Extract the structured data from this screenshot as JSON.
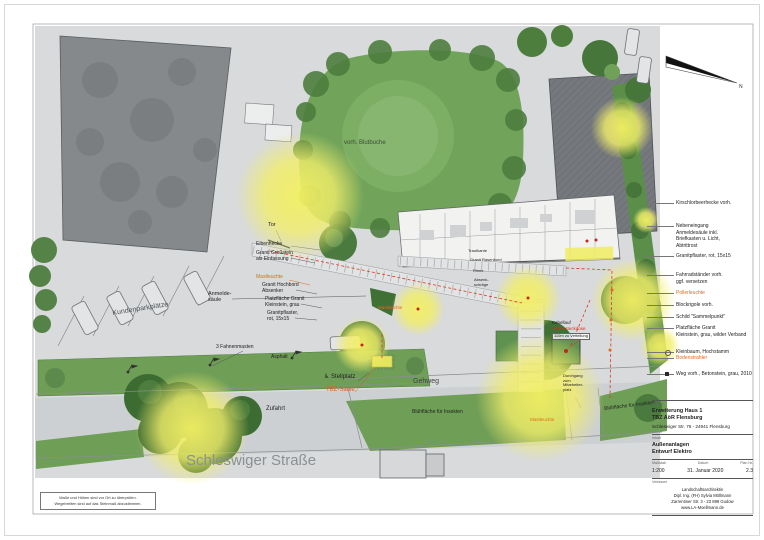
{
  "plan": {
    "labels": [
      {
        "text": "Tor",
        "x": 268,
        "y": 222,
        "size": 5.5
      },
      {
        "text": "Anmelde-\nsäule",
        "x": 208,
        "y": 291,
        "size": 5.5
      },
      {
        "text": "Eibenhecke",
        "x": 256,
        "y": 242,
        "size": 5
      },
      {
        "text": "Granit Großstein\nals Einfassung",
        "x": 256,
        "y": 251,
        "size": 5
      },
      {
        "text": "Mastleuchte",
        "x": 256,
        "y": 275,
        "size": 5,
        "color": "#e06a1f"
      },
      {
        "text": "Granit Hochbord\nAbsenker",
        "x": 262,
        "y": 283,
        "size": 5
      },
      {
        "text": "Platzfläche Granit\nKleinstein, grau",
        "x": 265,
        "y": 297,
        "size": 5
      },
      {
        "text": "Granitpflaster,\nrot, 15x15",
        "x": 267,
        "y": 311,
        "size": 5
      },
      {
        "text": "vorh. Blutbuche",
        "x": 344,
        "y": 140,
        "size": 6,
        "color": "#3c4a38"
      },
      {
        "text": "Kundenparkplätze",
        "x": 112,
        "y": 310,
        "size": 7,
        "rotate": -9,
        "color": "#4d5256"
      },
      {
        "text": "3 Fahnenmasten",
        "x": 216,
        "y": 345,
        "size": 5
      },
      {
        "text": "Asphalt",
        "x": 271,
        "y": 355,
        "size": 5
      },
      {
        "text": "♿ Stellplatz",
        "x": 324,
        "y": 374,
        "size": 6
      },
      {
        "text": "TBZ-Säule",
        "x": 326,
        "y": 387,
        "size": 6,
        "color": "#e8541e"
      },
      {
        "text": "Gehweg",
        "x": 413,
        "y": 378,
        "size": 7,
        "color": "#3f4447"
      },
      {
        "text": "Zufahrt",
        "x": 266,
        "y": 406,
        "size": 6
      },
      {
        "text": "Schleswiger Straße",
        "x": 186,
        "y": 452,
        "size": 15,
        "color": "#8b9094"
      },
      {
        "text": "Blühfläche für Insekten",
        "x": 412,
        "y": 410,
        "size": 5
      },
      {
        "text": "Blühfläche für Insekten",
        "x": 604,
        "y": 407,
        "size": 5,
        "rotate": -7
      },
      {
        "text": "Kabellauf",
        "x": 552,
        "y": 320,
        "size": 4.5
      },
      {
        "text": "Außensteckdose",
        "x": 552,
        "y": 326,
        "size": 4.5,
        "color": "#d6301c"
      },
      {
        "text": "110m zu Verteilung",
        "x": 552,
        "y": 333,
        "size": 4,
        "boxed": true
      },
      {
        "text": "Mastleuchte",
        "x": 378,
        "y": 305,
        "size": 4.5,
        "color": "#e06a1f"
      },
      {
        "text": "Mastleuchte",
        "x": 530,
        "y": 417,
        "size": 4.5,
        "color": "#e06a1f"
      },
      {
        "text": "Durchgang\nzum\nMitarbeiter-\nplatz",
        "x": 563,
        "y": 374,
        "size": 4
      },
      {
        "text": "Traufkante",
        "x": 468,
        "y": 249,
        "size": 4
      },
      {
        "text": "Granit Rasenbord",
        "x": 470,
        "y": 258,
        "size": 4
      },
      {
        "text": "Rinne",
        "x": 473,
        "y": 269,
        "size": 4
      },
      {
        "text": "Absenk-\nschräge",
        "x": 474,
        "y": 278,
        "size": 4
      }
    ]
  },
  "legend": {
    "items": [
      {
        "lines": "Kirschlorbeerhecke vorh.",
        "y": 200
      },
      {
        "lines": "Nebeneingang\nAnmeldesäule inkl.\nBriefkasten u. Licht,\nAbtrittrost",
        "y": 223
      },
      {
        "lines": "Granitpflaster, rot, 15x15",
        "y": 253
      },
      {
        "lines": "Fahrradständer vorh.\nggf. versetzen",
        "y": 272
      },
      {
        "lines": "Pollerleuchte",
        "y": 290,
        "color": "#e06a1f"
      },
      {
        "lines": "Blockrigole vorh.",
        "y": 302
      },
      {
        "lines": "Schild \"Sammelpunkt\"",
        "y": 314
      },
      {
        "lines": "Platzfläche Granit\nKleinstein, grau, wilder Verband",
        "y": 325
      },
      {
        "lines": "Kleinbaum, Hochstamm",
        "y": 349,
        "symbol": "circle"
      },
      {
        "lines": "Bodenstrahler",
        "y": 355,
        "color": "#e06a1f"
      },
      {
        "lines": "Weg vorh., Betonstein, grau, 2010",
        "y": 371,
        "symbol": "square"
      }
    ]
  },
  "north_arrow": {
    "label": "N"
  },
  "title_block": {
    "section_project_label": "Projekt",
    "project_line1": "Erweiterung Haus 1",
    "project_line2": "TBZ AöR Flensburg",
    "project_address": "Schleswiger Str. 76 - 24941 Flensburg",
    "section_content_label": "Inhalt",
    "content_line1": "Außenanlagen",
    "content_line2": "Entwurf Elektro",
    "scale_label": "Maßstab",
    "scale_value": "1:200",
    "date_label": "Datum",
    "date_value": "31. Januar 2020",
    "plan_no_label": "Plan Nr.",
    "plan_no_value": "2.3",
    "author_label": "Verfasser",
    "author_line1": "Landschaftsarchitektin",
    "author_line2": "Dipl. Ing. (FH) Sylvia Möllmann",
    "author_line3": "Zarrentiner Str. 3 - 23 899 Gudow",
    "author_line4": "www.LA-Moellmann.de"
  },
  "note_box": {
    "line1": "Maße und Höhen sind vor Ort zu überprüfen.",
    "line2": "Wegebreiten sind auf das Steinmaß abzustimmen."
  },
  "colors": {
    "accent_orange": "#e06a1f",
    "accent_red": "#d6301c",
    "glow_yellow": "#f1ee6a",
    "lawn_green": "#71a45a",
    "paving_gray": "#d8dadc"
  }
}
